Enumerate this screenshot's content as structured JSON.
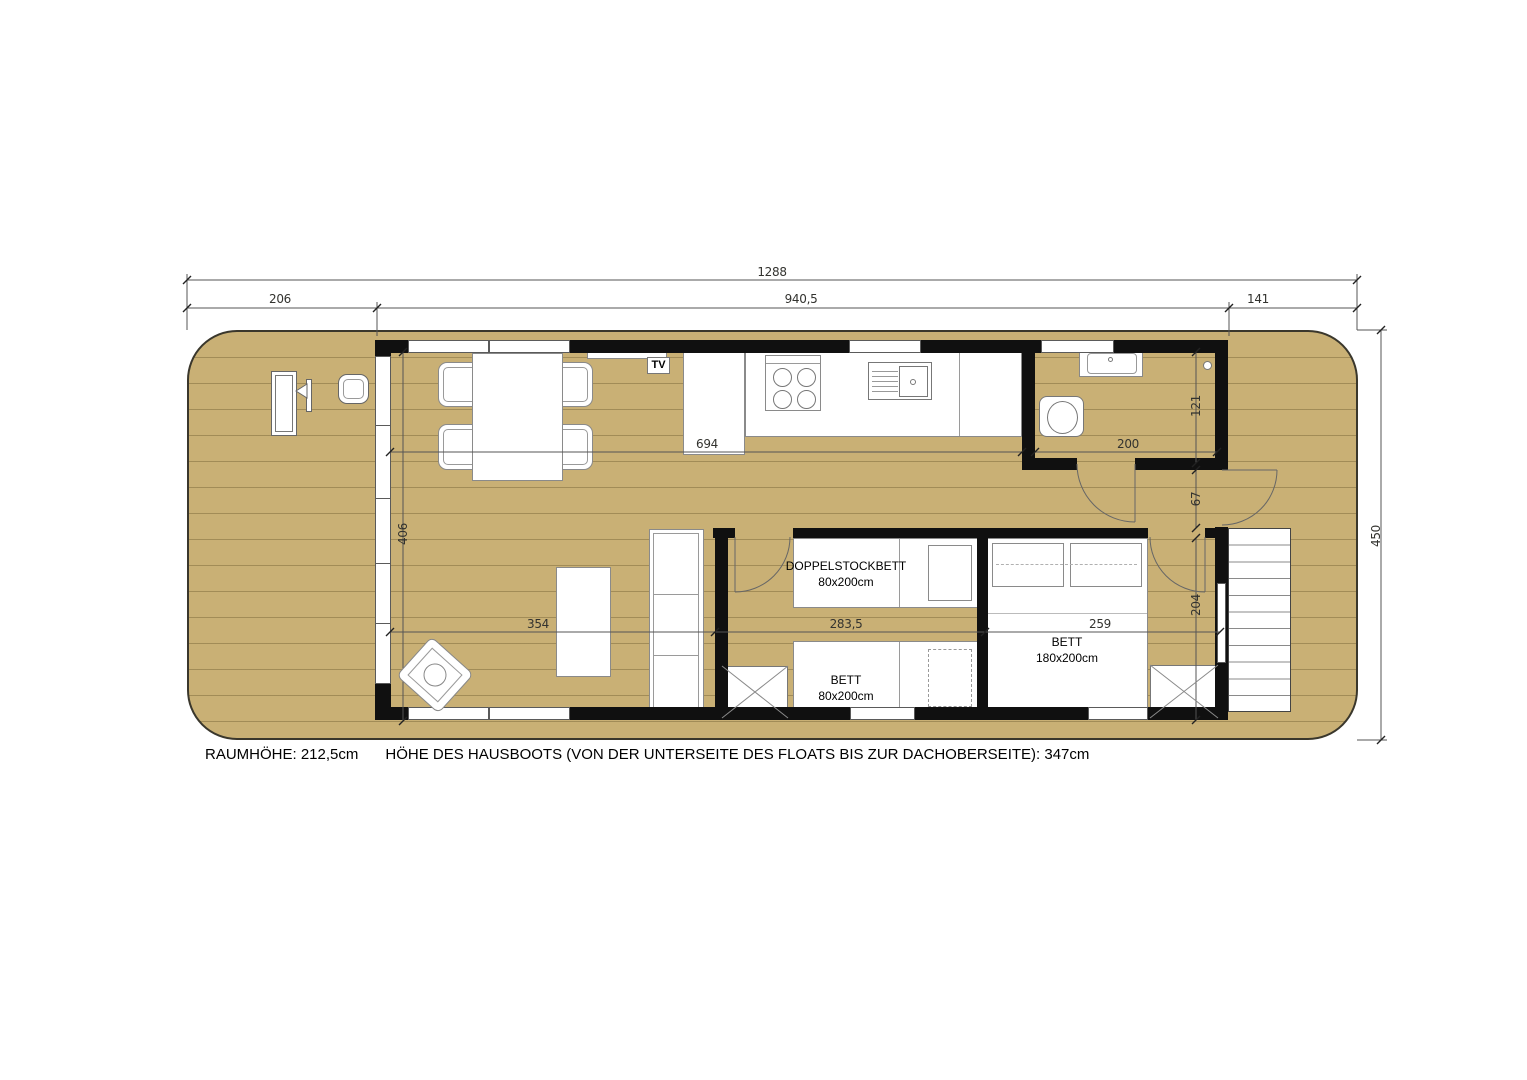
{
  "plan": {
    "dimensions": {
      "overall_length": "1288",
      "front_deck_length": "206",
      "cabin_length": "940,5",
      "rear_deck_length": "141",
      "overall_width": "450",
      "living_kitchen_length": "694",
      "living_width": "406",
      "living_zone_length": "354",
      "kids_room_length": "283,5",
      "master_room_length": "259",
      "bathroom_length": "200",
      "bathroom_width": "121",
      "hallway_width": "67",
      "bedroom_width": "204"
    },
    "labels": {
      "tv": "TV",
      "bunk_bed_name": "DOPPELSTOCKBETT",
      "bunk_bed_size": "80x200cm",
      "single_bed_name": "BETT",
      "single_bed_size": "80x200cm",
      "double_bed_name": "BETT",
      "double_bed_size": "180x200cm"
    },
    "notes": {
      "room_height": "RAUMHÖHE: 212,5cm",
      "boat_height": "HÖHE DES HAUSBOOTS (VON DER UNTERSEITE DES FLOATS BIS ZUR DACHOBERSEITE): 347cm"
    },
    "colors": {
      "deck": "#c9b075",
      "wall": "#101010",
      "dimension_line": "#444444"
    }
  }
}
